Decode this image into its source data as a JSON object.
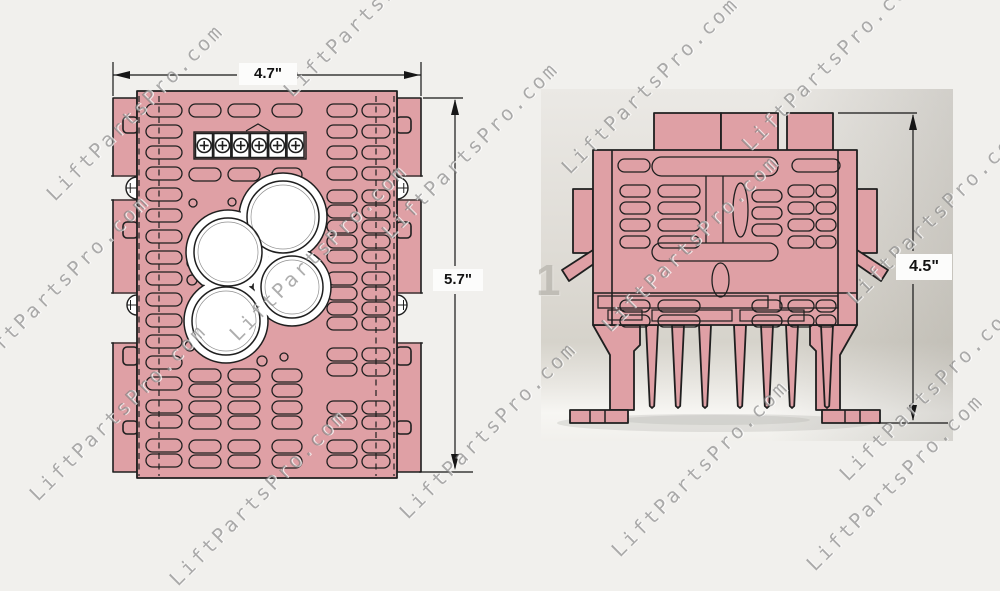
{
  "watermark": {
    "text": "LiftPartsPro.com"
  },
  "dimensions": {
    "top_view_width": "4.7\"",
    "top_view_height": "5.7\"",
    "side_view_height": "4.5\""
  },
  "photo_marking": {
    "numeral": "1"
  },
  "colors": {
    "part_fill": "#dfa0a5",
    "outline": "#1f1f1f",
    "page_background": "#f1f0ed",
    "photo_background": "#dcd9d3",
    "watermark_gray": "#8f8d8a",
    "dimension_ink": "#161616"
  }
}
